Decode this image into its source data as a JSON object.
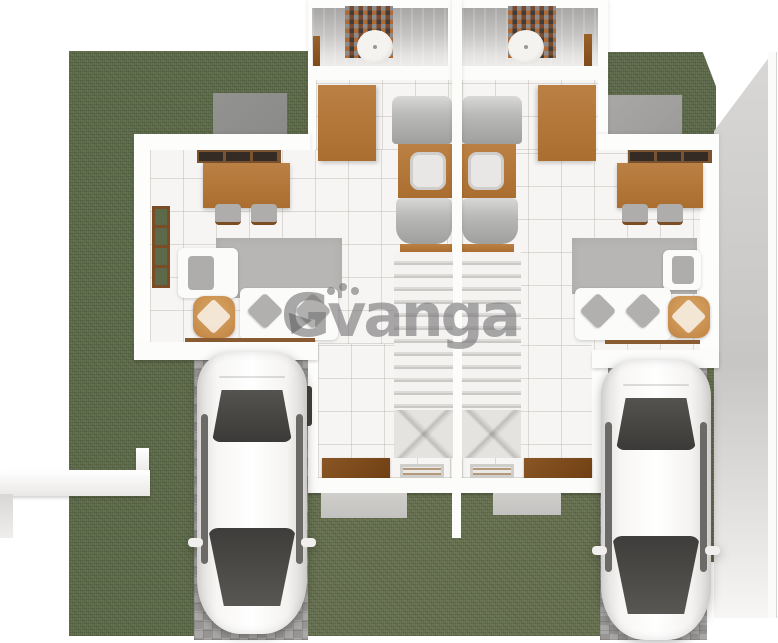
{
  "watermark": {
    "text": "Gvanga",
    "part_g": "G",
    "part_rest": "vanga",
    "color": "#767576"
  },
  "scene": {
    "kind": "3d-top-down-floorplan-render",
    "subject": "duplex house with two mirrored units, yards and two parked cars",
    "units": [
      {
        "name": "left-unit",
        "rooms": [
          "bathroom",
          "hallway",
          "kitchen",
          "dining-area",
          "living-room",
          "stairs",
          "entry"
        ],
        "furniture": [
          "dining-table",
          "two-chairs",
          "rug",
          "sofa",
          "armchair",
          "ottoman",
          "wardrobe",
          "fridge",
          "sink-counter",
          "stove",
          "doormat",
          "floor-grill"
        ]
      },
      {
        "name": "right-unit",
        "rooms": [
          "bathroom",
          "hallway",
          "kitchen",
          "dining-area",
          "living-room",
          "stairs",
          "entry"
        ],
        "furniture": [
          "dining-table",
          "two-chairs",
          "rug",
          "sofa",
          "armchair",
          "ottoman",
          "wardrobe",
          "fridge",
          "sink-counter",
          "stove",
          "doormat",
          "floor-grill"
        ]
      }
    ],
    "exterior": [
      "left-yard-grass",
      "right-courtyard-grass",
      "bottom-yard-grass",
      "left-driveway-pavers",
      "right-driveway-pavers",
      "concrete-pads",
      "low-garden-fence",
      "right-perimeter-wall",
      "white-car-left",
      "white-car-right"
    ],
    "colors": {
      "grass": "#5e6b4a",
      "grass_light": "#67724f",
      "pavers": "#a09f9d",
      "walls": "#fdfdfc",
      "floor_tile": "#f6f5f3",
      "wood": "#b5793b",
      "wood_dark": "#7e4c1c",
      "ottoman": "#c8904e",
      "rug": "#b7b6b4",
      "stainless": "#b9b9b7",
      "car_body": "#f7f6f4",
      "car_glass": "#45443f",
      "mosaic_accent": "#b06a35",
      "watermark": "#767576"
    }
  }
}
